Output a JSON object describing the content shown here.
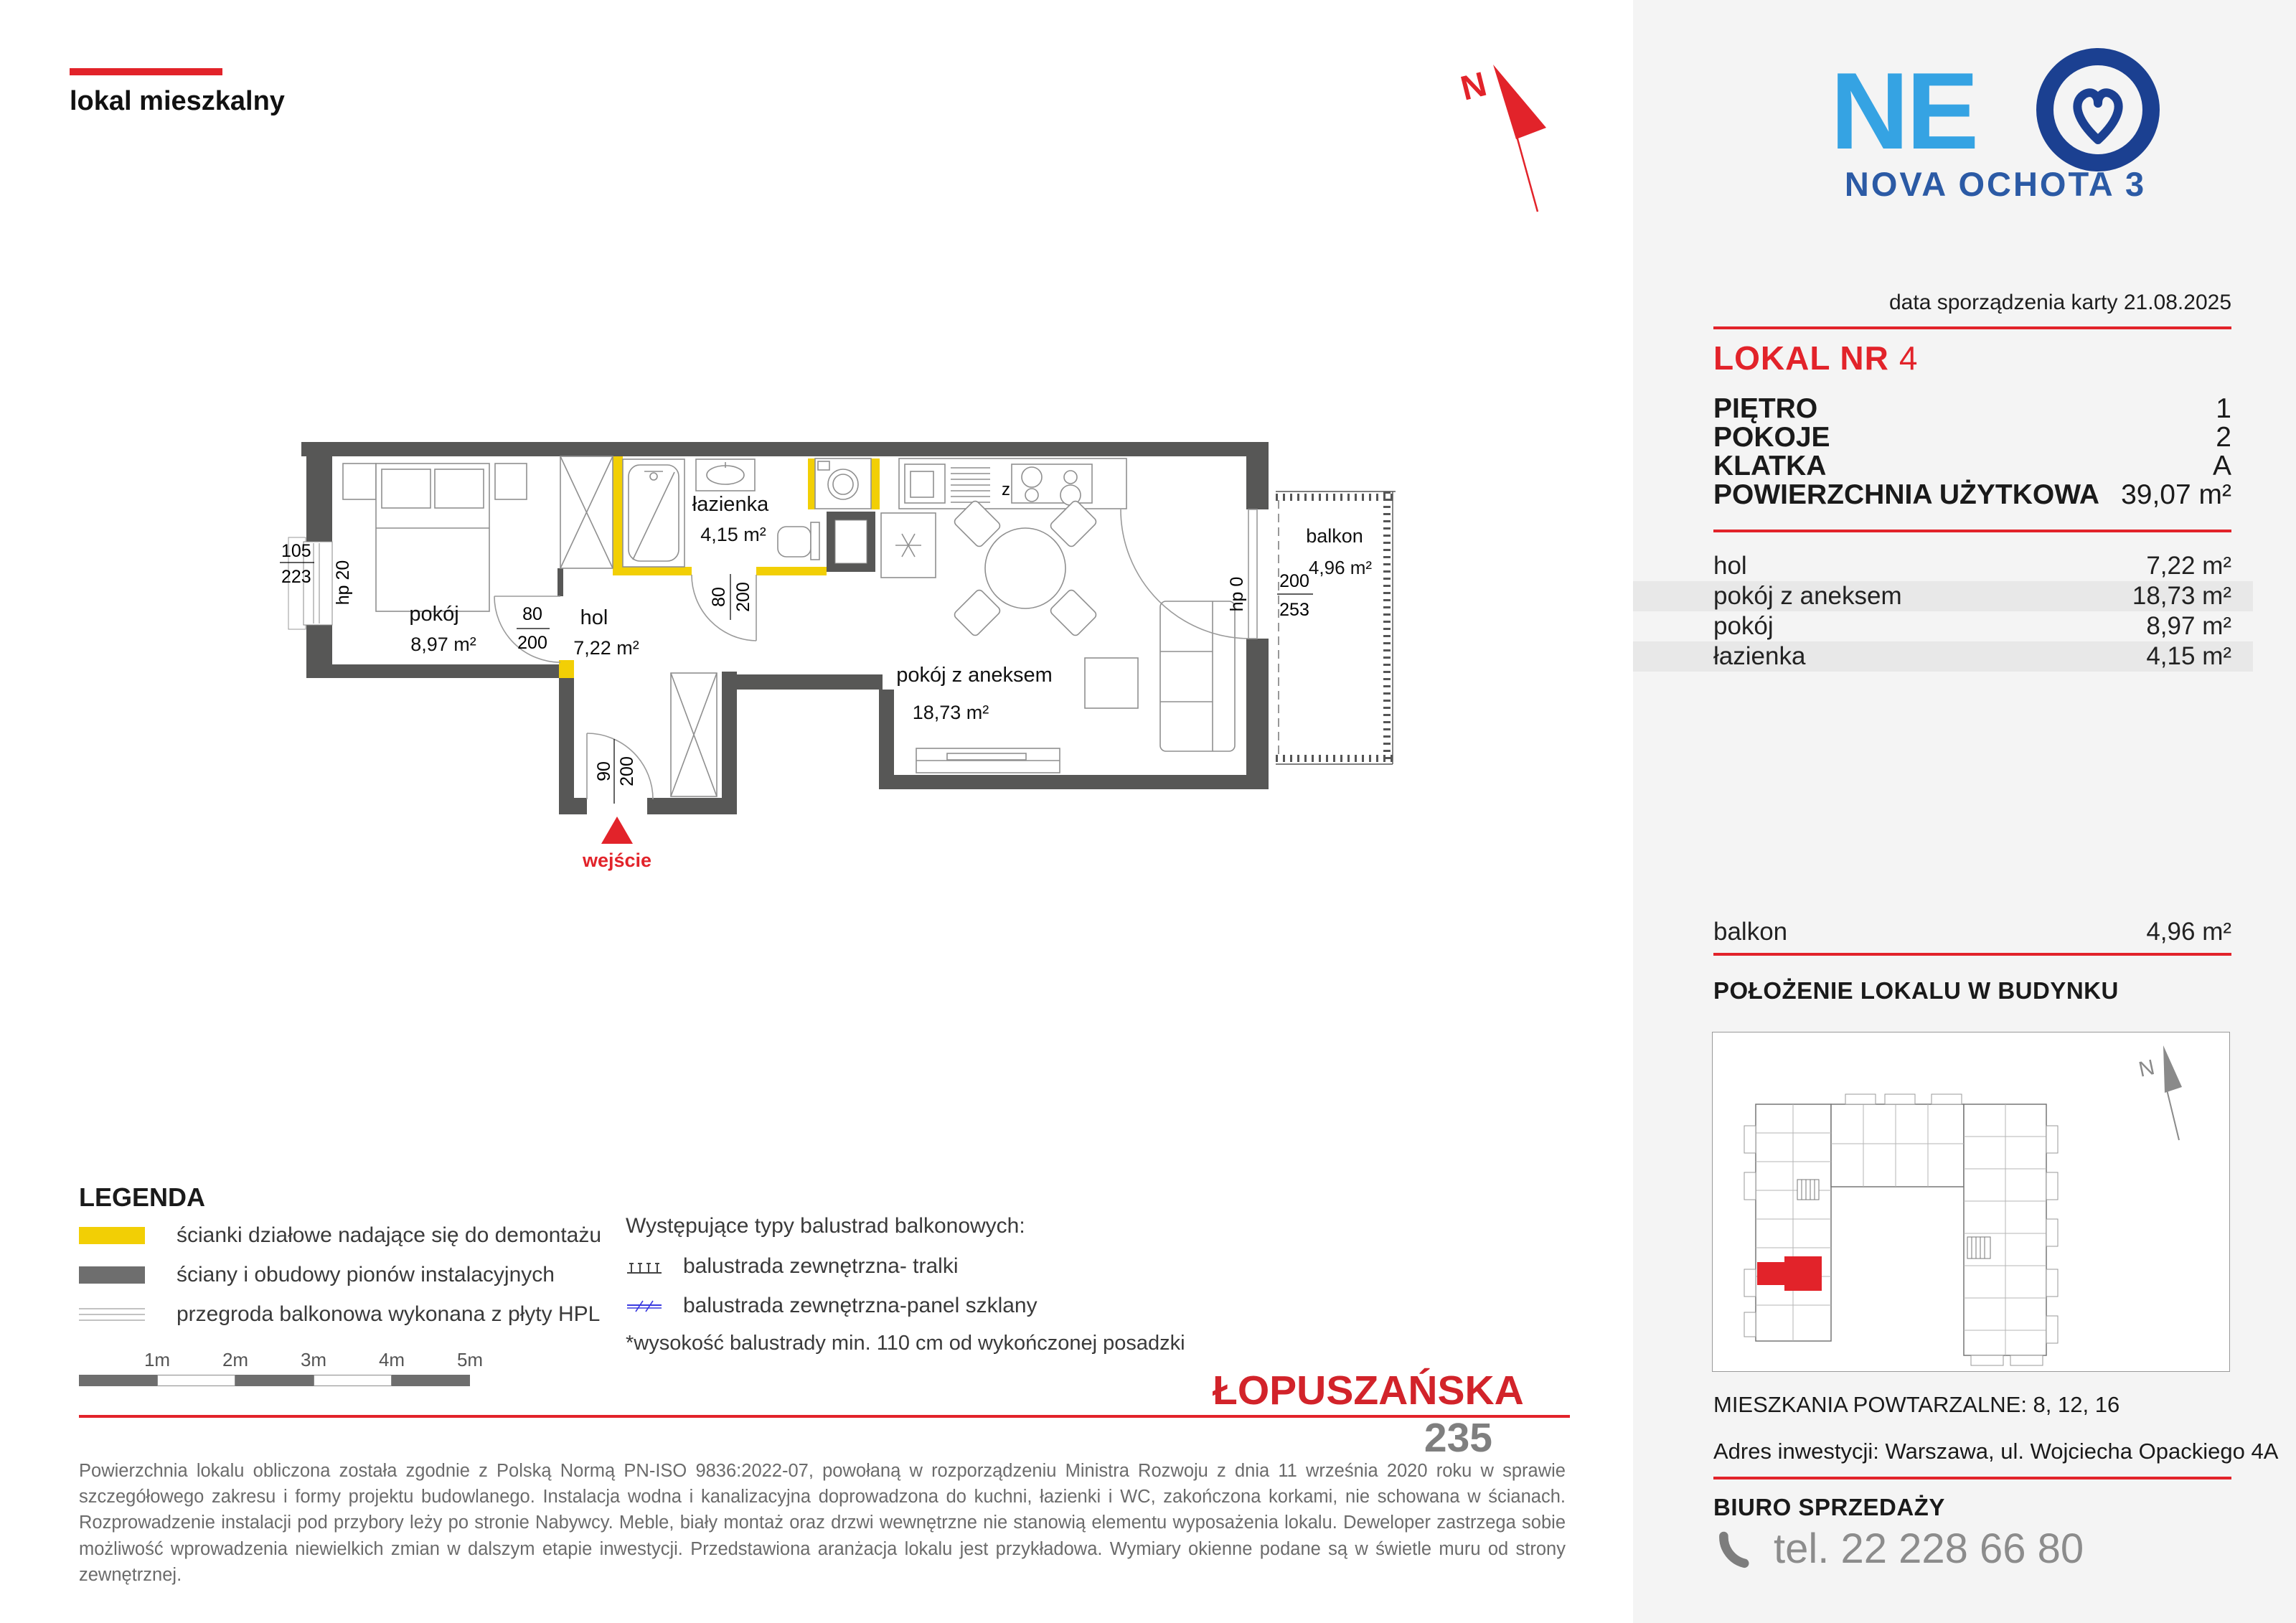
{
  "meta": {
    "type_label": "lokal mieszkalny"
  },
  "compass": {
    "n": "N"
  },
  "logo": {
    "ne": "NE",
    "subtitle": "NOVA OCHOTA 3"
  },
  "card": {
    "date": "data sporządzenia karty 21.08.2025",
    "unit_label": "LOKAL NR",
    "unit_number": "4",
    "attributes": [
      {
        "label": "PIĘTRO",
        "value": "1"
      },
      {
        "label": "POKOJE",
        "value": "2"
      },
      {
        "label": "KLATKA",
        "value": "A"
      },
      {
        "label": "POWIERZCHNIA UŻYTKOWA",
        "value": "39,07 m²"
      }
    ],
    "rooms": [
      {
        "label": "hol",
        "value": "7,22 m²"
      },
      {
        "label": "pokój z aneksem",
        "value": "18,73 m²"
      },
      {
        "label": "pokój",
        "value": "8,97 m²"
      },
      {
        "label": "łazienka",
        "value": "4,15 m²"
      }
    ],
    "balcony_label": "balkon",
    "balcony_value": "4,96 m²"
  },
  "location": {
    "heading": "POŁOŻENIE LOKALU W BUDYNKU",
    "repeat_note": "MIESZKANIA POWTARZALNE: 8, 12, 16",
    "address": "Adres inwestycji: Warszawa, ul. Wojciecha Opackiego 4A"
  },
  "sales": {
    "heading": "BIURO SPRZEDAŻY",
    "phone": "tel. 22 228 66 80"
  },
  "plan": {
    "rooms": {
      "bedroom": {
        "name": "pokój",
        "area": "8,97 m²"
      },
      "hall": {
        "name": "hol",
        "area": "7,22 m²"
      },
      "bath": {
        "name": "łazienka",
        "area": "4,15 m²"
      },
      "living": {
        "name": "pokój z aneksem",
        "area": "18,73 m²"
      },
      "balcony": {
        "name": "balkon",
        "area": "4,96 m²"
      }
    },
    "dims": {
      "window_w": "105",
      "window_h": "223",
      "window_hp": "hp 20",
      "bedroom_door_w": "80",
      "bedroom_door_h": "200",
      "bath_door_w": "80",
      "bath_door_h": "200",
      "entry_w": "90",
      "entry_h": "200",
      "balcony_door_w": "200",
      "balcony_door_h": "253",
      "balcony_hp": "hp 0"
    },
    "entrance_label": "wejście",
    "dishwasher_label": "z"
  },
  "legend": {
    "heading": "LEGENDA",
    "items": [
      {
        "label": "ścianki działowe nadające się do demontażu"
      },
      {
        "label": "ściany i obudowy pionów instalacyjnych"
      },
      {
        "label": "przegroda balkonowa wykonana z płyty HPL"
      }
    ],
    "balustrade_heading": "Występujące typy balustrad balkonowych:",
    "balustrade_items": [
      {
        "label": "balustrada zewnętrzna- tralki"
      },
      {
        "label": "balustrada zewnętrzna-panel szklany"
      }
    ],
    "note": "*wysokość balustrady min. 110 cm od wykończonej posadzki",
    "scale_labels": [
      "1m",
      "2m",
      "3m",
      "4m",
      "5m"
    ]
  },
  "project": {
    "name": "ŁOPUSZAŃSKA",
    "number": "235"
  },
  "disclaimer": "Powierzchnia lokalu obliczona została zgodnie z Polską Normą PN-ISO 9836:2022-07, powołaną w rozporządzeniu Ministra Rozwoju z dnia 11 września 2020 roku w sprawie szczegółowego zakresu i formy projektu budowlanego. Instalacja wodna i kanalizacyjna doprowadzona do kuchni, łazienki i WC, zakończona korkami, nie schowana w ścianach. Rozprowadzenie instalacji pod przybory leży po stronie Nabywcy. Meble, biały montaż oraz drzwi wewnętrzne nie stanowią elementu wyposażenia lokalu. Deweloper zastrzega sobie możliwość wprowadzenia niewielkich zmian w dalszym etapie inwestycji. Przedstawiona aranżacja lokalu jest przykładowa. Wymiary okienne podane są w świetle muru od strony zewnętrznej.",
  "colors": {
    "red": "#e2232a",
    "yellow": "#f2cf05",
    "wall": "#575756",
    "blue_light": "#35a3e3",
    "blue_dark": "#1b4091"
  }
}
